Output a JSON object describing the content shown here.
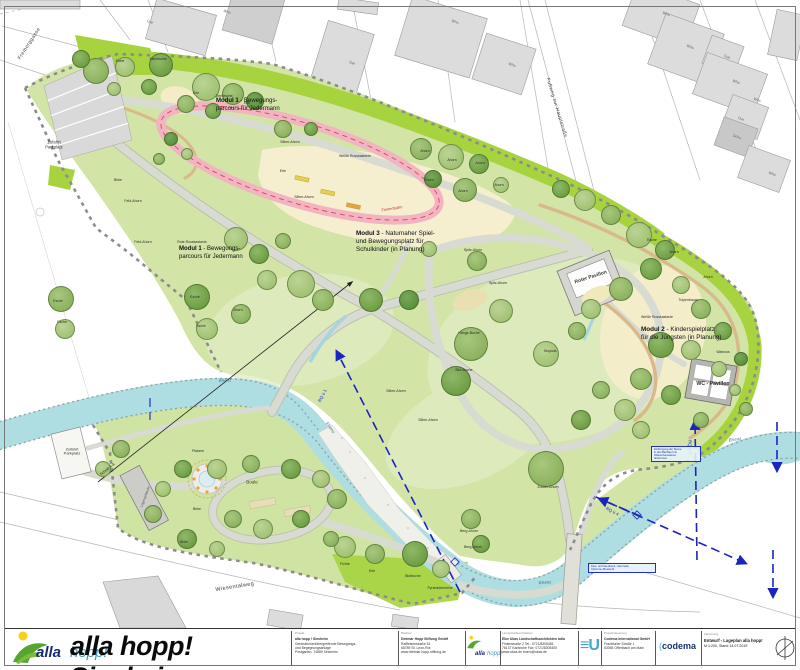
{
  "map": {
    "modules": [
      {
        "x": 216,
        "y": 98,
        "s": 6,
        "lines": [
          {
            "b": "Modul 1",
            "r": " - Bewegungs-"
          },
          {
            "b": "",
            "r": "parcours für Jedermann"
          }
        ]
      },
      {
        "x": 179,
        "y": 246,
        "s": 6,
        "lines": [
          {
            "b": "Modul 1",
            "r": " - Bewegungs-"
          },
          {
            "b": "",
            "r": "parcours für Jedermann"
          }
        ]
      },
      {
        "x": 356,
        "y": 230,
        "s": 6.3,
        "lines": [
          {
            "b": "Modul 3",
            "r": " - Naturnaher Spiel-"
          },
          {
            "b": "",
            "r": "und Bewegungsplatz für"
          },
          {
            "b": "",
            "r": "Schulkinder (in Planung)"
          }
        ]
      },
      {
        "x": 641,
        "y": 326,
        "s": 6.3,
        "lines": [
          {
            "b": "Modul 2",
            "r": " - Kinderspielplatz"
          },
          {
            "b": "",
            "r": "für die Jüngsten (in Planung)"
          }
        ]
      }
    ],
    "street_labels": [
      {
        "t": "Freiberggasse",
        "x": 30,
        "y": 44,
        "r": -57,
        "s": 5
      },
      {
        "t": "Fußweg zur Hauptstraße",
        "x": 556,
        "y": 108,
        "r": 73,
        "s": 4.8
      },
      {
        "t": "Wiesentalweg",
        "x": 235,
        "y": 588,
        "r": -9,
        "s": 5.5
      }
    ],
    "river_labels": [
      {
        "t": "Elsenz",
        "x": 225,
        "y": 381,
        "r": -5,
        "s": 4.2
      },
      {
        "t": "Elsenz",
        "x": 330,
        "y": 428,
        "r": 55,
        "s": 4.2
      },
      {
        "t": "Elsenz",
        "x": 735,
        "y": 440,
        "r": -8,
        "s": 4.2
      },
      {
        "t": "Elsenz",
        "x": 545,
        "y": 583,
        "r": -4,
        "s": 4.2
      }
    ],
    "access_labels": [
      {
        "t": "Zufahrt\nParkplatz",
        "x": 54,
        "y": 145,
        "s": 4.2
      },
      {
        "t": "Zufahrt\nParkplatz",
        "x": 72,
        "y": 452,
        "s": 4
      }
    ],
    "building_labels": [
      {
        "t": "Gar",
        "x": 150,
        "y": 22,
        "r": 18
      },
      {
        "t": "Whs",
        "x": 227,
        "y": 12,
        "r": 18
      },
      {
        "t": "Gar",
        "x": 352,
        "y": 63,
        "r": 18
      },
      {
        "t": "Whs",
        "x": 455,
        "y": 22,
        "r": 18
      },
      {
        "t": "Whs",
        "x": 512,
        "y": 65,
        "r": 18
      },
      {
        "t": "Whs",
        "x": 666,
        "y": 14,
        "r": 20
      },
      {
        "t": "Whs",
        "x": 690,
        "y": 47,
        "r": 20
      },
      {
        "t": "Gar",
        "x": 727,
        "y": 57,
        "r": 20
      },
      {
        "t": "Whs",
        "x": 736,
        "y": 82,
        "r": 20
      },
      {
        "t": "Whs",
        "x": 757,
        "y": 100,
        "r": 20
      },
      {
        "t": "Gar",
        "x": 741,
        "y": 119,
        "r": 20
      },
      {
        "t": "Schu",
        "x": 737,
        "y": 137,
        "r": 20
      },
      {
        "t": "Whs",
        "x": 772,
        "y": 174,
        "r": 20
      }
    ],
    "tree_labels": [
      {
        "t": "Eiche",
        "x": 120,
        "y": 62
      },
      {
        "t": "Zierkirsche",
        "x": 158,
        "y": 60
      },
      {
        "t": "Erle",
        "x": 196,
        "y": 94
      },
      {
        "t": "Zierkirsche",
        "x": 224,
        "y": 97
      },
      {
        "t": "Erle",
        "x": 247,
        "y": 104
      },
      {
        "t": "Birke",
        "x": 118,
        "y": 181
      },
      {
        "t": "Feld-Ahorn",
        "x": 133,
        "y": 202
      },
      {
        "t": "Feld-Ahorn",
        "x": 143,
        "y": 243
      },
      {
        "t": "Rote Rosskastanie",
        "x": 192,
        "y": 243
      },
      {
        "t": "Silber-Ahorn",
        "x": 290,
        "y": 143
      },
      {
        "t": "Erle",
        "x": 283,
        "y": 172
      },
      {
        "t": "Silber-Ahorn",
        "x": 304,
        "y": 198
      },
      {
        "t": "Weiße Rosskastanie",
        "x": 355,
        "y": 157
      },
      {
        "t": "Ahorn",
        "x": 425,
        "y": 152
      },
      {
        "t": "Ahorn",
        "x": 452,
        "y": 161
      },
      {
        "t": "Ahorn",
        "x": 480,
        "y": 164
      },
      {
        "t": "Ahorn",
        "x": 429,
        "y": 181
      },
      {
        "t": "Ahorn",
        "x": 463,
        "y": 192
      },
      {
        "t": "Ahorn",
        "x": 499,
        "y": 186
      },
      {
        "t": "Esche",
        "x": 58,
        "y": 302
      },
      {
        "t": "Esche",
        "x": 62,
        "y": 323
      },
      {
        "t": "Esche",
        "x": 195,
        "y": 298
      },
      {
        "t": "Esche",
        "x": 201,
        "y": 327
      },
      {
        "t": "Ahorn",
        "x": 238,
        "y": 311
      },
      {
        "t": "Spitz-Ahorn",
        "x": 473,
        "y": 251
      },
      {
        "t": "Spitz-Ahorn",
        "x": 498,
        "y": 284
      },
      {
        "t": "Hänge-Buche",
        "x": 469,
        "y": 334
      },
      {
        "t": "Blut-Buche",
        "x": 464,
        "y": 371
      },
      {
        "t": "Silber-Ahorn",
        "x": 396,
        "y": 392
      },
      {
        "t": "Silber-Ahorn",
        "x": 428,
        "y": 421
      },
      {
        "t": "Esche",
        "x": 652,
        "y": 241
      },
      {
        "t": "Ahorn",
        "x": 674,
        "y": 253
      },
      {
        "t": "Tulpenbaum",
        "x": 688,
        "y": 301
      },
      {
        "t": "Weiße Rosskastanie",
        "x": 657,
        "y": 318
      },
      {
        "t": "Walnuss",
        "x": 723,
        "y": 353
      },
      {
        "t": "Ahorn",
        "x": 708,
        "y": 278
      },
      {
        "t": "Sequoia",
        "x": 550,
        "y": 352
      },
      {
        "t": "Zucker-Ahorn",
        "x": 548,
        "y": 488
      },
      {
        "t": "Fichte",
        "x": 345,
        "y": 565
      },
      {
        "t": "Erle",
        "x": 372,
        "y": 572
      },
      {
        "t": "Blutbuche",
        "x": 413,
        "y": 577
      },
      {
        "t": "Pyramideneiche",
        "x": 440,
        "y": 589
      },
      {
        "t": "Berg-Ahorn",
        "x": 469,
        "y": 532
      },
      {
        "t": "Berg-Ahorn",
        "x": 473,
        "y": 548
      },
      {
        "t": "Platane",
        "x": 198,
        "y": 452
      },
      {
        "t": "Birke",
        "x": 197,
        "y": 510
      },
      {
        "t": "Birke",
        "x": 184,
        "y": 543
      }
    ],
    "misc_labels": [
      {
        "t": "Boule",
        "x": 252,
        "y": 483,
        "s": 4.5,
        "c": "#333333",
        "n": "boule-label"
      },
      {
        "t": "Finnenbahn",
        "x": 392,
        "y": 209,
        "r": -9,
        "s": 4,
        "c": "#c03a3a",
        "n": "track-label"
      },
      {
        "t": "RQ ü 1",
        "x": 323,
        "y": 396,
        "r": -62,
        "s": 4.3,
        "c": "#1a25c0",
        "n": "section-line-label"
      },
      {
        "t": "RQ II-5",
        "x": 689,
        "y": 447,
        "r": 90,
        "s": 4.3,
        "c": "#1a25c0",
        "n": "section-line-label"
      },
      {
        "t": "RQ ü 4",
        "x": 612,
        "y": 512,
        "r": 28,
        "s": 4.3,
        "c": "#1a25c0",
        "n": "section-line-label"
      },
      {
        "t": "Roter Pavillon",
        "x": 591,
        "y": 278,
        "r": -18,
        "s": 5,
        "c": "#3c3c3c",
        "w": 600,
        "n": "pavilion-label"
      },
      {
        "t": "WC - Pavillon",
        "x": 713,
        "y": 385,
        "s": 5.2,
        "c": "#2e2e2e",
        "w": 600,
        "n": "wc-pavilion-label"
      },
      {
        "t": "Lagergebäude",
        "x": 146,
        "y": 497,
        "r": -70,
        "s": 3.4,
        "c": "#555555",
        "n": "building-label"
      },
      {
        "t": "Schnitt A-A",
        "x": 108,
        "y": 470,
        "r": -38,
        "s": 3.6,
        "c": "#222222",
        "n": "section-label"
      }
    ],
    "annotations": [
      {
        "x": 651,
        "y": 446,
        "w": 44,
        "lines": [
          "Einbringung der Steine",
          "in den Bachlauf mit",
          "Wasserbausteinen",
          "abstimmen"
        ]
      },
      {
        "x": 588,
        "y": 563,
        "w": 62,
        "lines": [
          "Kies- und Sandbank, naturnahe",
          "Uferzone (Bestand)"
        ]
      }
    ]
  },
  "titlebar": {
    "logo_text_1": "alla",
    "logo_text_2": "hopp!",
    "title": "alla hopp! Sinsheim",
    "cells": [
      {
        "x": 291,
        "w": 100,
        "header": "Projekt",
        "bold_first": true,
        "lines": [
          "alla hopp ! Sinsheim",
          "Generationenübergreifende Bewegungs-",
          "und Begegnungsanlage",
          "Postgarten, 74889 Sinsheim"
        ]
      },
      {
        "x": 397,
        "w": 62,
        "header": "Bauherr",
        "bold_first": true,
        "lines": [
          "Dietmar Hopp Stiftung GmbH",
          "Raiffeisenstraße 51",
          "68789 St. Leon-Rot",
          "www.dietmar-hopp-stiftung.de"
        ]
      },
      {
        "x": 498,
        "w": 75,
        "header": "Landschaftsarchitekten",
        "bold_first": true,
        "lines": [
          "Elke Ukas Landschaftsarchitekten bdla",
          "Fintenstraße 2    Tel.: 0721/8305481",
          "76137 Karlsruhe  Fax: 0721/8305400",
          "www.ukas.de      buero@ukas.de"
        ]
      },
      {
        "x": 600,
        "w": 52,
        "header": "Projektsteuerung",
        "bold_first": true,
        "lines": [
          "Codema International GmbH",
          "Frankfurter Straße 1",
          "63065 Offenbach am Main"
        ]
      }
    ],
    "eu_logo_u": "U",
    "codema_logo": "codema",
    "drawing": {
      "header": "Zeichnung",
      "line1": "Entwurf - Lageplan alla hopp!",
      "line2": "M 1:200, Stand 14.07.2015"
    }
  }
}
